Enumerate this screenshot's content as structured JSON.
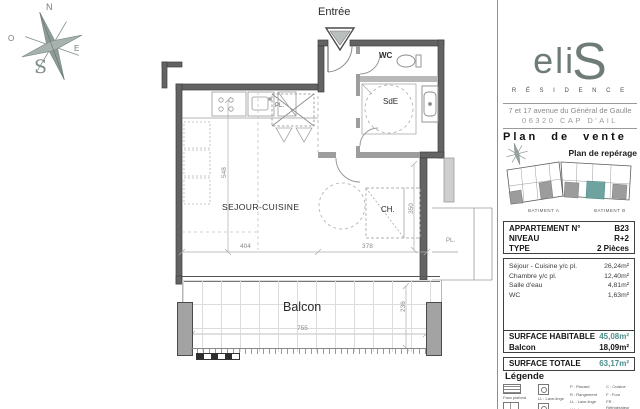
{
  "brand": {
    "logo_text": "eli",
    "logo_s": "S",
    "residence": "R É S I D E N C E",
    "address_line1": "7 et 17 avenue du Général de Gaulle",
    "address_line2": "06320 CAP D'AIL",
    "accent_color": "#4e8f8c"
  },
  "titles": {
    "plan_de_vente": "Plan de vente",
    "plan_de_reperage": "Plan de repérage",
    "batiment_a": "BATIMENT A",
    "batiment_b": "BATIMENT B"
  },
  "apartment": {
    "rows": [
      {
        "label": "APPARTEMENT N°",
        "value": "B23"
      },
      {
        "label": "NIVEAU",
        "value": "R+2"
      },
      {
        "label": "TYPE",
        "value": "2 Pièces"
      }
    ]
  },
  "rooms": [
    {
      "name": "Séjour - Cuisine y/c pl.",
      "area": "26,24m²"
    },
    {
      "name": "Chambre y/c pl.",
      "area": "12,40m²"
    },
    {
      "name": "Salle d'eau",
      "area": "4,81m²"
    },
    {
      "name": "WC",
      "area": "1,63m²"
    }
  ],
  "surfaces": {
    "habitable_label": "SURFACE HABITABLE",
    "habitable_value": "45,08m²",
    "balcon_label": "Balcon",
    "balcon_value": "18,09m²",
    "totale_label": "SURFACE TOTALE",
    "totale_value": "63,17m²"
  },
  "legend": {
    "title": "Légende",
    "items": [
      {
        "label": "Faux plafond"
      },
      {
        "label": "Placard / dressing"
      },
      {
        "label": "LL : Lave-linge"
      },
      {
        "label": "SL : Sèche-linge"
      }
    ],
    "abbr1": [
      "P : Placard",
      "R : Rangement",
      "LL : Lave-linge",
      "LV : Lave-vaisselle"
    ],
    "abbr2": [
      "C : Cuisine",
      "F : Four",
      "FR : Réfrigérateur",
      "SL : Sèche-linge"
    ]
  },
  "plan": {
    "entree": "Entrée",
    "sejour": "SEJOUR-CUISINE",
    "wc": "WC",
    "sde": "SdE",
    "chambre": "CH.",
    "placard": "PL.",
    "placard2": "PL.",
    "balcon": "Balcon",
    "compass": {
      "n": "N",
      "o": "O",
      "e": "E",
      "s": "S"
    },
    "dims": {
      "sejour_w": "404",
      "ch_w": "378",
      "sejour_h": "548",
      "ch_h": "350",
      "balcon_w": "755",
      "balcon_h": "236"
    }
  }
}
